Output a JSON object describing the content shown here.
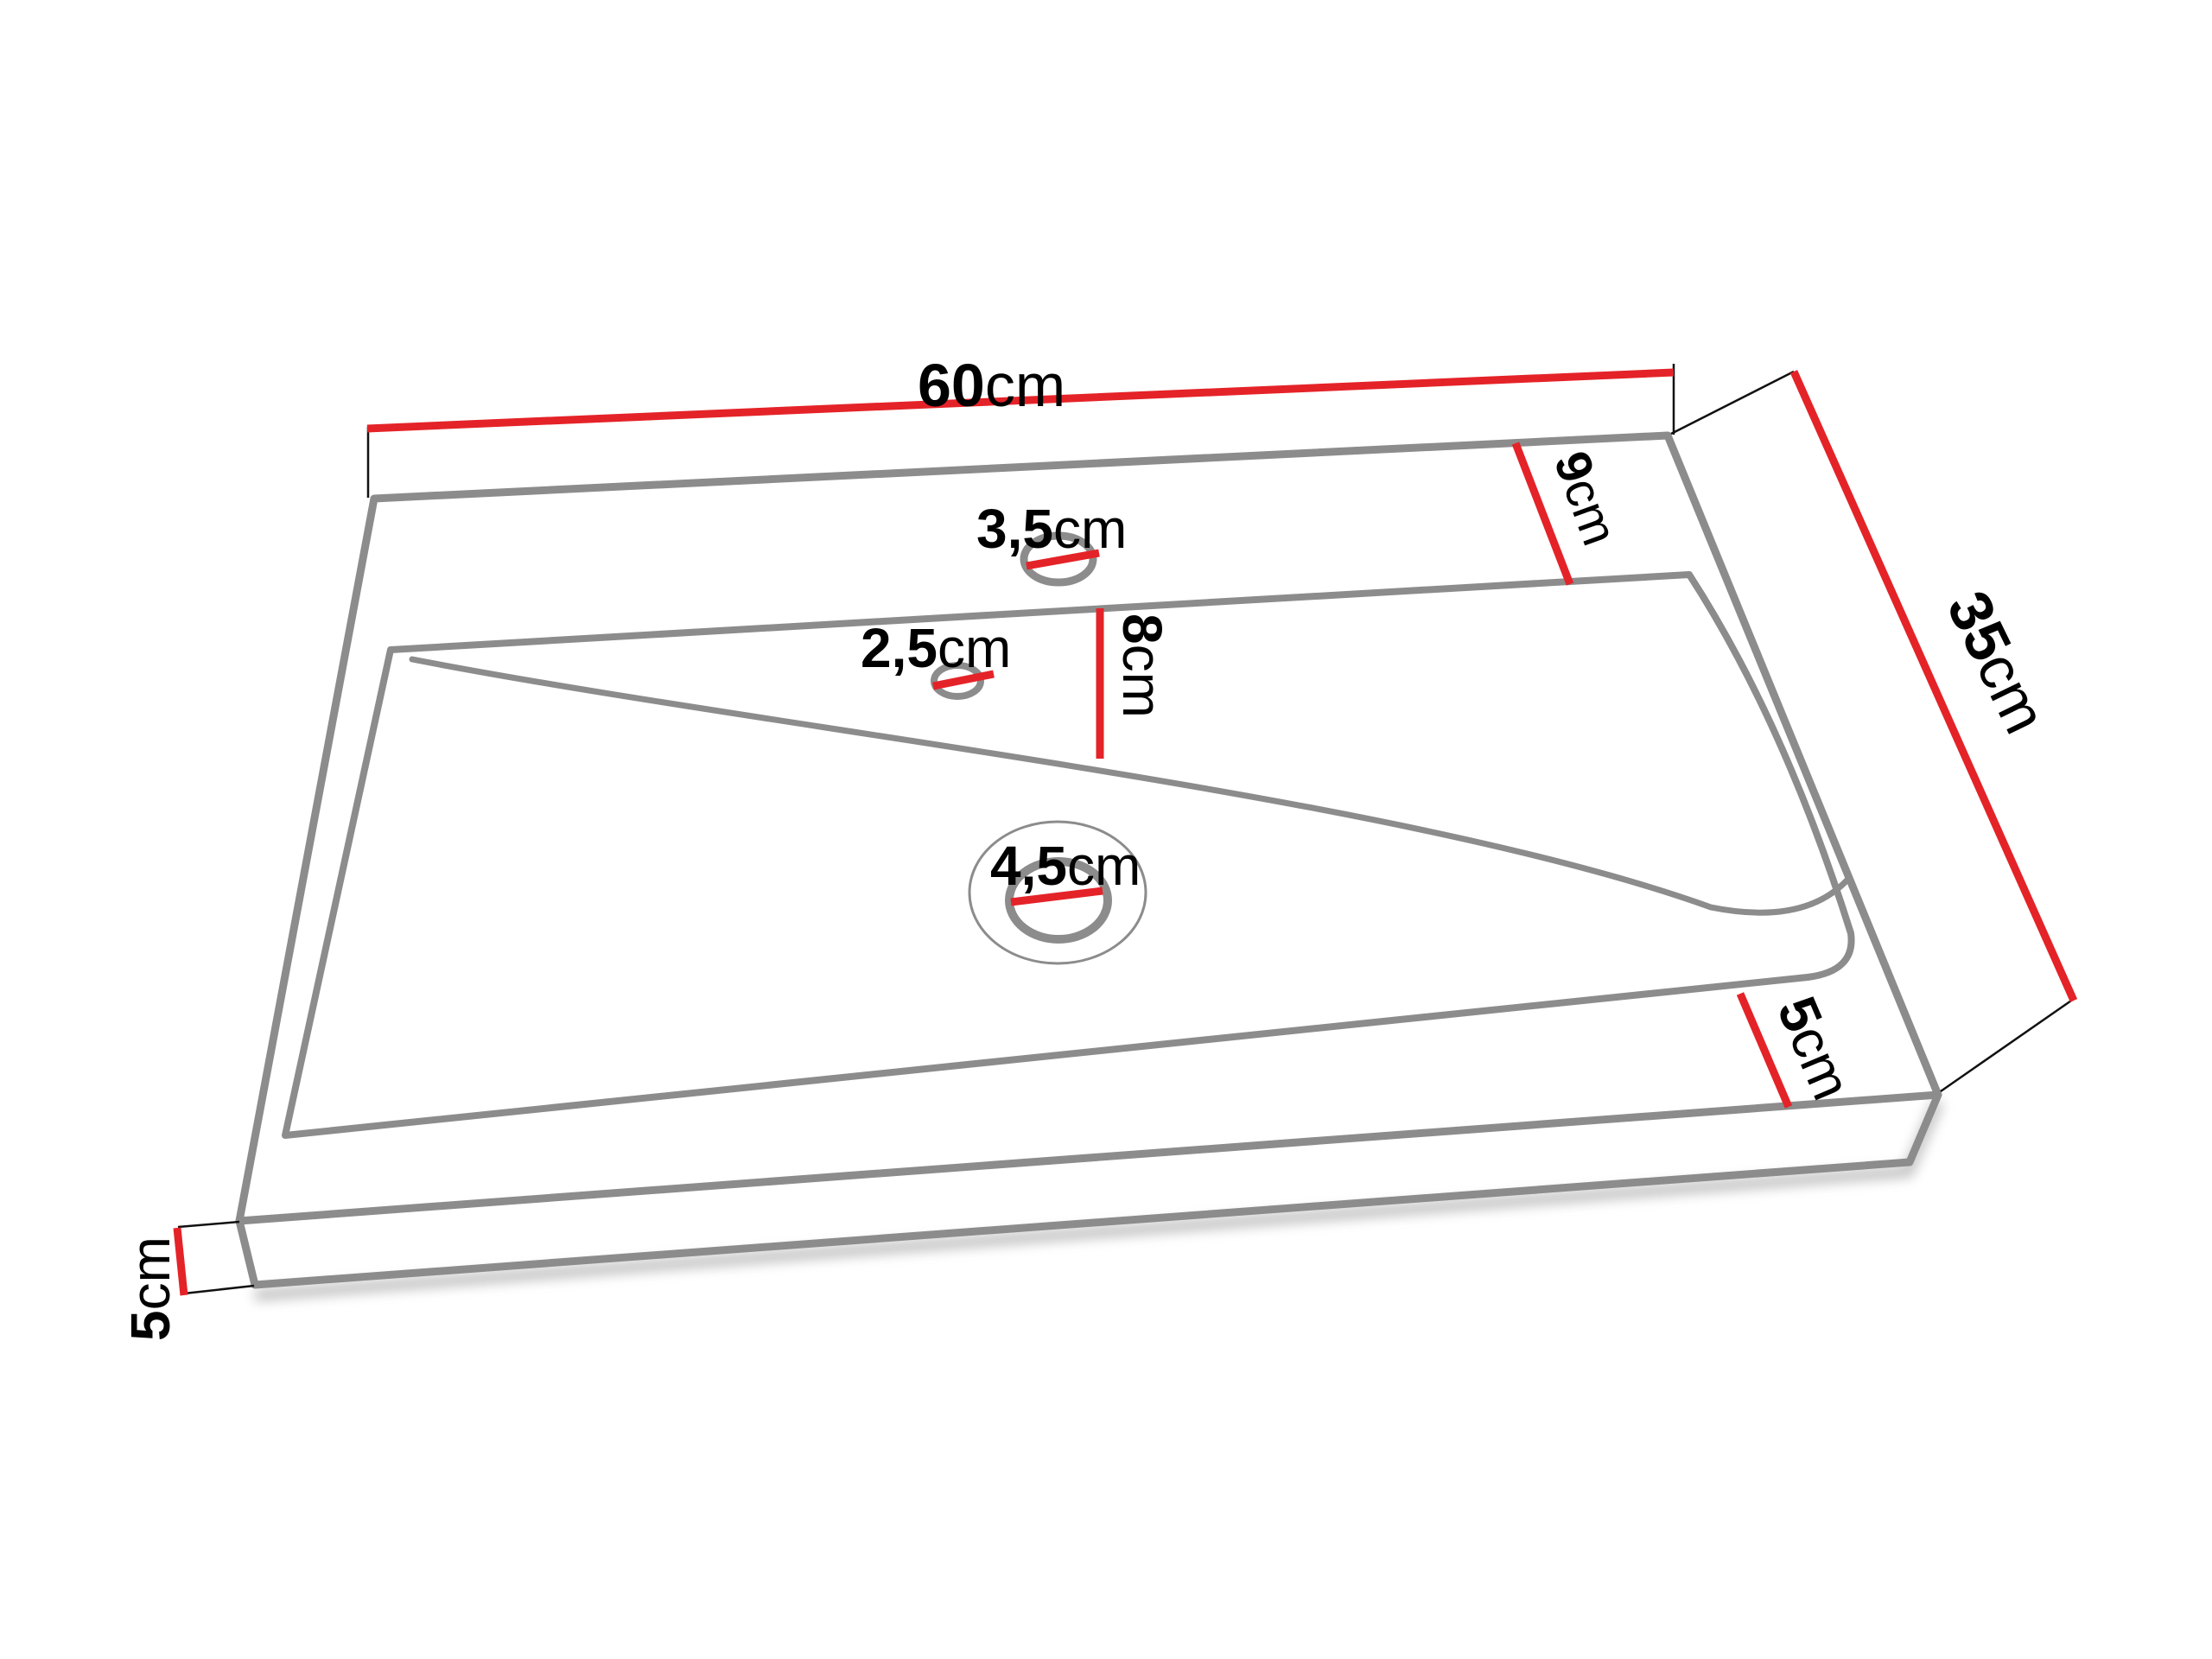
{
  "diagram": {
    "type": "technical-drawing",
    "subject": "washbasin-top-with-dimensions",
    "unit": "cm",
    "labels": {
      "top_width": {
        "value": "60",
        "unit": "cm"
      },
      "side_depth": {
        "value": "35",
        "unit": "cm"
      },
      "back_rim_depth": {
        "value": "9",
        "unit": "cm"
      },
      "basin_depth": {
        "value": "8",
        "unit": "cm"
      },
      "faucet_hole_diameter": {
        "value": "3,5",
        "unit": "cm"
      },
      "overflow_hole_diameter": {
        "value": "2,5",
        "unit": "cm"
      },
      "drain_hole_diameter": {
        "value": "4,5",
        "unit": "cm"
      },
      "front_rim_width": {
        "value": "5",
        "unit": "cm"
      },
      "slab_thickness": {
        "value": "5",
        "unit": "cm"
      }
    },
    "colors": {
      "dimension_line": "#e42328",
      "outline": "#8c8c8c",
      "text": "#000000",
      "background": "#ffffff"
    }
  }
}
